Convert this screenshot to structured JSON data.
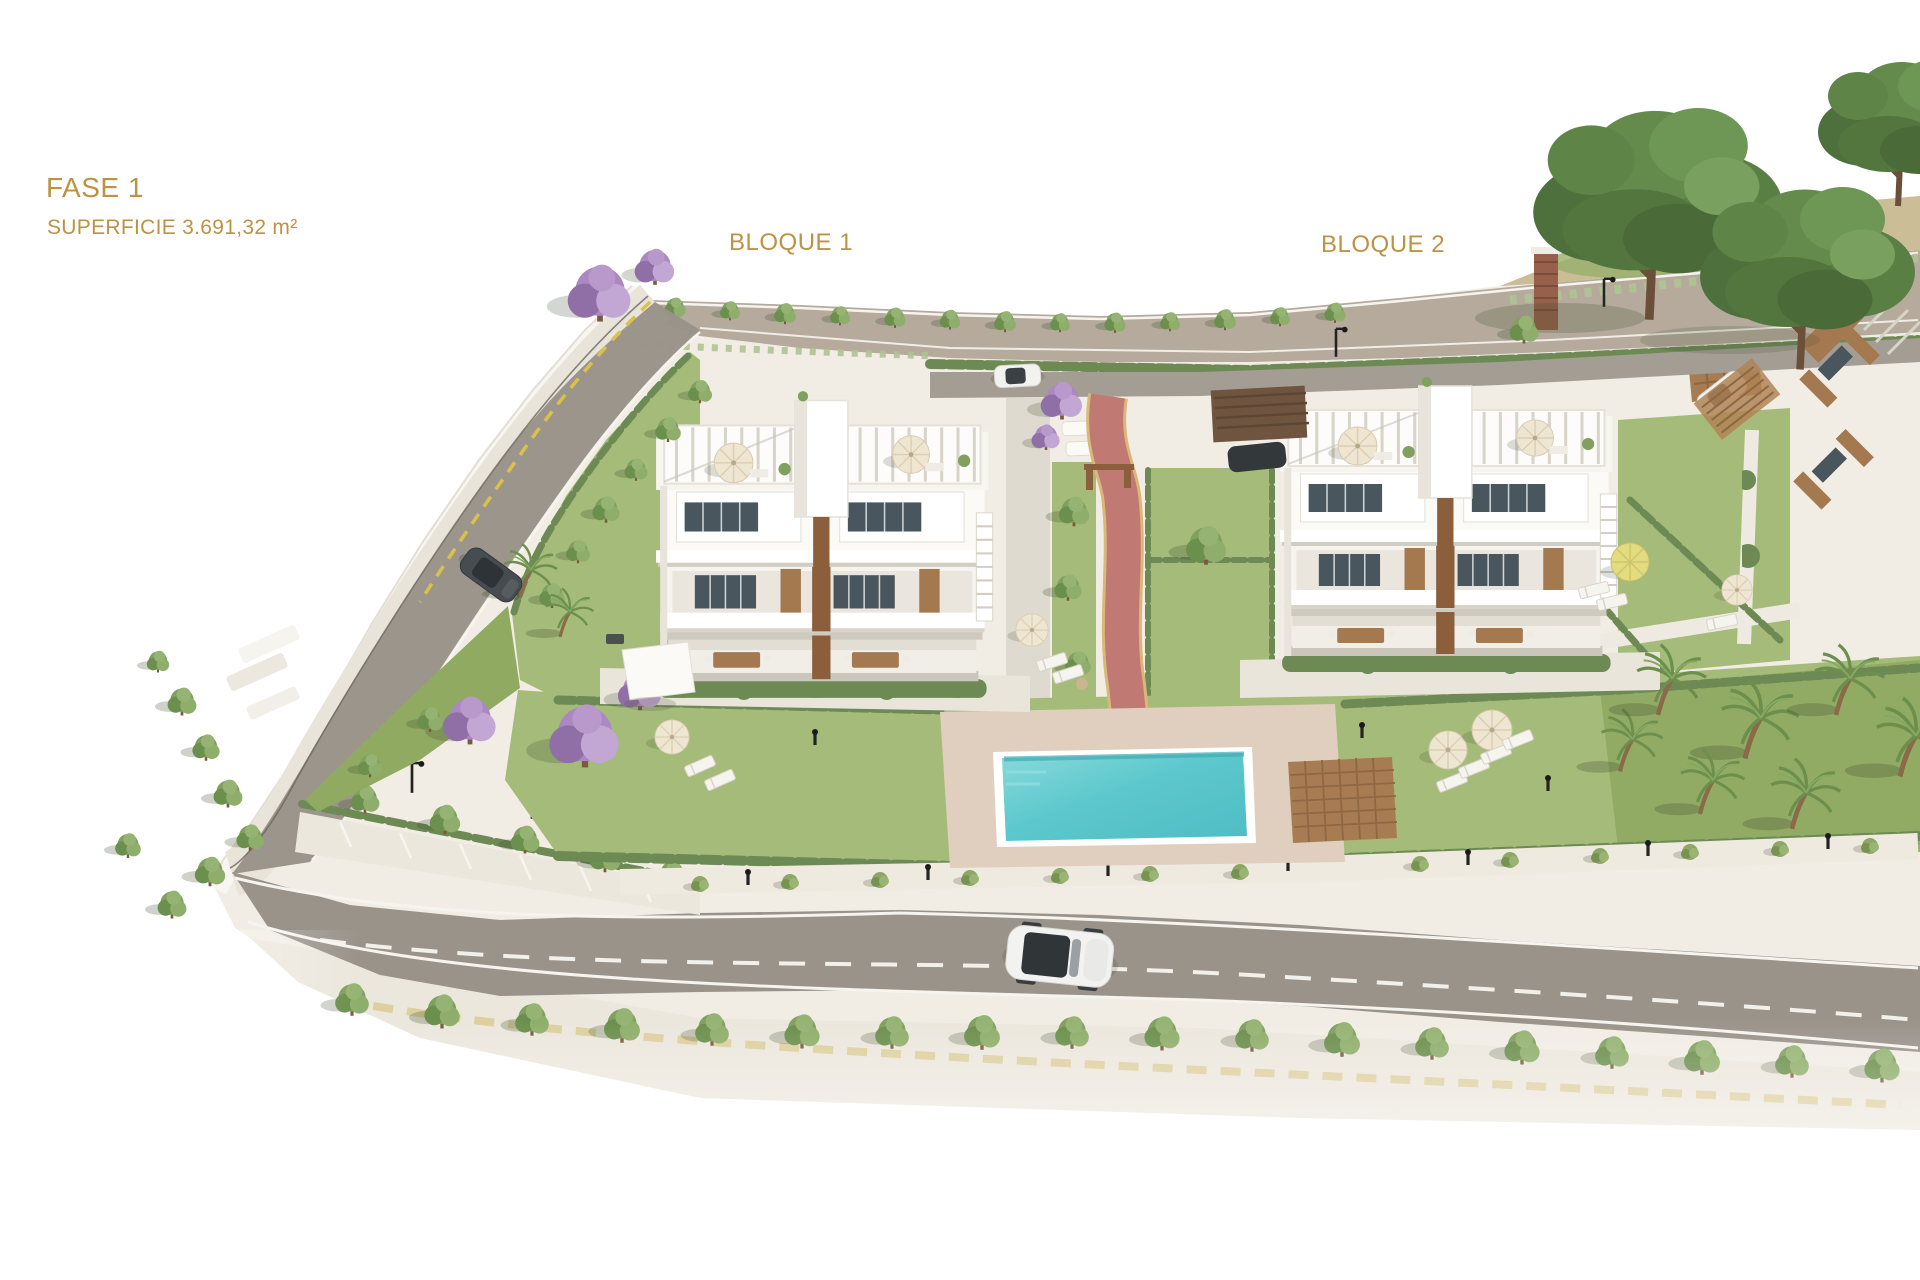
{
  "page": {
    "background": "#ffffff",
    "kind": "residential masterplan 3D render"
  },
  "plan": {
    "phase_label": "FASE 1",
    "area_label": "SUPERFICIE 3.691,32 m²",
    "blocks": [
      {
        "id": "bloque-1",
        "label": "BLOQUE 1"
      },
      {
        "id": "bloque-2",
        "label": "BLOQUE 2"
      }
    ]
  },
  "palette": {
    "accent-text": "#bd9243",
    "terrain": "#f1ede5",
    "terrain-light": "#f8f6f2",
    "road": "#99938a",
    "road-top": "#b5aa9c",
    "road-inner": "#a49d94",
    "sidewalk": "#ece7dd",
    "lawn": "#a5bb79",
    "lawn-dark": "#90aa62",
    "hedge": "#6d8954",
    "tree": "#7fa05e",
    "tree-dark": "#4e703c",
    "palm": "#6c8f4d",
    "jacaranda": "#ab88c2",
    "pool-water": "#5cc8cd",
    "pool-water-light": "#85d6d8",
    "pool-deck": "#e0cfbe",
    "wood-deck": "#a87c52",
    "wood-accent": "#a5794f",
    "wood-dark": "#8b5e3c",
    "glass": "#49565d",
    "building-white": "#ffffff",
    "red-path": "#c17974",
    "path-edge-yellow": "#d9b878",
    "line-white": "#f6f4ef",
    "lamp-black": "#232323",
    "mound-dry": "#cbbe96",
    "brick": "#96604a",
    "car-dark": "#474c50",
    "car-white": "#f2f2f0"
  }
}
